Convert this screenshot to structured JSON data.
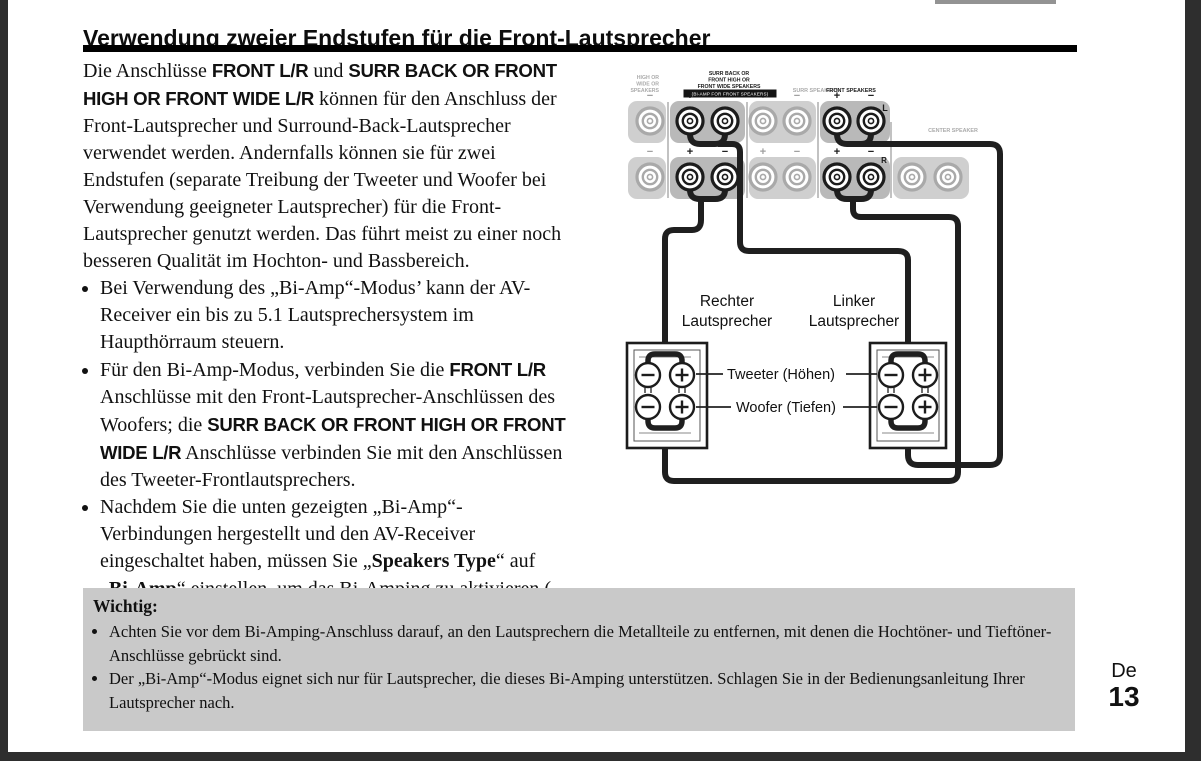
{
  "title": "Verwendung zweier Endstufen für die Front-Lautsprecher",
  "intro": [
    {
      "t": "Die Anschlüsse "
    },
    {
      "t": "FRONT L/R",
      "b": true
    },
    {
      "t": " und "
    },
    {
      "t": "SURR BACK OR FRONT HIGH OR FRONT WIDE L/R",
      "b": true
    },
    {
      "t": " können für den Anschluss der Front-Lautsprecher und Surround-Back-Lautsprecher verwendet werden. Andernfalls können sie für zwei Endstufen (separate Treibung der Tweeter und Woofer bei Verwendung geeigneter Lautsprecher) für die Front-Lautsprecher genutzt werden. Das führt meist zu einer noch besseren Qualität im Hochton- und Bassbereich."
    }
  ],
  "bullets": [
    [
      {
        "t": "Bei Verwendung des „Bi-Amp“-Modus’ kann der AV-Receiver ein bis zu 5.1 Lautsprechersystem im Haupthörraum steuern."
      }
    ],
    [
      {
        "t": "Für den Bi-Amp-Modus, verbinden Sie die "
      },
      {
        "t": "FRONT L/R",
        "b": true
      },
      {
        "t": " Anschlüsse mit den Front-Lautsprecher-Anschlüssen des Woofers; die "
      },
      {
        "t": "SURR BACK OR FRONT HIGH OR FRONT WIDE L/R",
        "b": true
      },
      {
        "t": " Anschlüsse verbinden Sie mit den Anschlüssen des Tweeter-Frontlautsprechers."
      }
    ],
    [
      {
        "t": "Nachdem Sie die unten gezeigten „Bi-Amp“-Verbindungen hergestellt und den AV-Receiver eingeschaltet haben, müssen Sie „"
      },
      {
        "t": "Speakers Type",
        "sb": true
      },
      {
        "t": "“ auf „"
      },
      {
        "t": "Bi-Amp",
        "sb": true
      },
      {
        "t": "“ einstellen, um das Bi-Amping zu aktivieren ("
      },
      {
        "t": "→ 39",
        "b": true
      },
      {
        "t": ")."
      }
    ]
  ],
  "important": {
    "heading": "Wichtig:",
    "items": [
      "Achten Sie vor dem Bi-Amping-Anschluss darauf, an den Lautsprechern die Metallteile zu entfernen, mit denen die Hochtöner- und Tieftöner-Anschlüsse gebrückt sind.",
      "Der „Bi-Amp“-Modus eignet sich nur für Lautsprecher, die dieses Bi-Amping unterstützen. Schlagen Sie in der Bedienungsanleitung Ihrer Lautsprecher nach."
    ]
  },
  "pageno": {
    "lang": "De",
    "number": "13"
  },
  "diagram": {
    "panel": {
      "clipped_label": [
        "HIGH OR",
        "WIDE OR",
        "SPEAKERS"
      ],
      "surr_back_label": [
        "SURR BACK OR",
        "FRONT HIGH OR",
        "FRONT WIDE SPEAKERS"
      ],
      "surr_back_badge": "(BI-AMP FOR FRONT SPEAKERS)",
      "surr_label": "SURR SPEAKERS",
      "front_label": "FRONT SPEAKERS",
      "center_label": "CENTER SPEAKER",
      "left_channel": "L",
      "right_channel": "R",
      "plus": "+",
      "minus": "−"
    },
    "right_speaker": [
      "Rechter",
      "Lautsprecher"
    ],
    "left_speaker": [
      "Linker",
      "Lautsprecher"
    ],
    "tweeter_label": "Tweeter (Höhen)",
    "woofer_label": "Woofer (Tiefen)"
  }
}
